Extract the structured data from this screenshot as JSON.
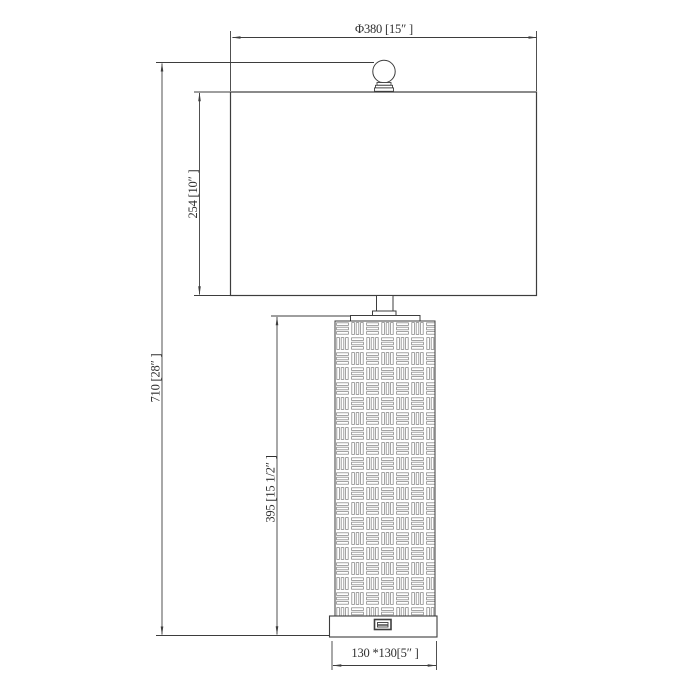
{
  "drawing": {
    "description": "Table lamp technical line drawing with basket-weave body, finial ball, rectangular shade, USB port on base, and dimension annotations",
    "colors": {
      "ink": "#3d3d3d",
      "pattern_ink": "#8c8c8c",
      "background": "#ffffff"
    },
    "dimensions": {
      "shade_diameter": {
        "label": "Φ380 [15″ ]",
        "mm": 380,
        "inches": "15″"
      },
      "total_height": {
        "label": "710 [28″ ]",
        "mm": 710,
        "inches": "28″"
      },
      "shade_height": {
        "label": "254 [10″ ]",
        "mm": 254,
        "inches": "10″"
      },
      "body_height": {
        "label": "395 [15 1/2″ ]",
        "mm": 395,
        "inches": "15 1/2″"
      },
      "base_footprint": {
        "label": "130 *130[5″ ]",
        "mm": "130 × 130",
        "inches": "5″"
      }
    }
  }
}
